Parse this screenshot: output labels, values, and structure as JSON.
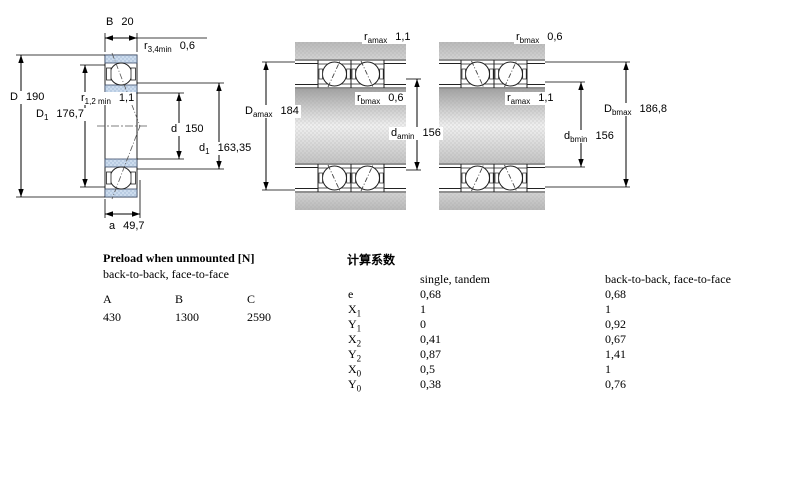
{
  "colors": {
    "bearing_ring_fill": "#ccdcee",
    "bearing_ring_dots": "#9db4d2",
    "line": "#000000",
    "housing_gray": "#c0c0c0",
    "shaft_gradient_light": "#f0f0f0",
    "background": "#ffffff"
  },
  "drawing_labels": {
    "single": {
      "B": {
        "base": "B",
        "sub": "",
        "value": "20"
      },
      "r34": {
        "base": "r",
        "sub": "3,4min",
        "value": "0,6"
      },
      "D": {
        "base": "D",
        "sub": "",
        "value": "190"
      },
      "D1": {
        "base": "D",
        "sub": "1",
        "value": "176,7"
      },
      "r12": {
        "base": "r",
        "sub": "1,2 min",
        "value": "1,1"
      },
      "d": {
        "base": "d",
        "sub": "",
        "value": "150"
      },
      "d1": {
        "base": "d",
        "sub": "1",
        "value": "163,35"
      },
      "a": {
        "base": "a",
        "sub": "",
        "value": "49,7"
      }
    },
    "pair_face_to_face": {
      "r_amax": {
        "base": "r",
        "sub": "amax",
        "value": "1,1"
      },
      "r_bmax": {
        "base": "r",
        "sub": "bmax",
        "value": "0,6"
      },
      "D_amax": {
        "base": "D",
        "sub": "amax",
        "value": "184"
      },
      "d_amin": {
        "base": "d",
        "sub": "amin",
        "value": "156"
      }
    },
    "pair_back_to_back": {
      "r_bmax": {
        "base": "r",
        "sub": "bmax",
        "value": "0,6"
      },
      "r_amax": {
        "base": "r",
        "sub": "amax",
        "value": "1,1"
      },
      "D_bmax": {
        "base": "D",
        "sub": "bmax",
        "value": "186,8"
      },
      "d_bmin": {
        "base": "d",
        "sub": "bmin",
        "value": "156"
      }
    }
  },
  "preload": {
    "title": "Preload when unmounted [N]",
    "subtitle": "back-to-back, face-to-face",
    "columns": [
      "A",
      "B",
      "C"
    ],
    "values": [
      "430",
      "1300",
      "2590"
    ]
  },
  "factors": {
    "title": "计算系数",
    "col1_header": "single, tandem",
    "col2_header": "back-to-back, face-to-face",
    "rows": [
      {
        "base": "e",
        "sub": "",
        "v1": "0,68",
        "v2": "0,68"
      },
      {
        "base": "X",
        "sub": "1",
        "v1": "1",
        "v2": "1"
      },
      {
        "base": "Y",
        "sub": "1",
        "v1": "0",
        "v2": "0,92"
      },
      {
        "base": "X",
        "sub": "2",
        "v1": "0,41",
        "v2": "0,67"
      },
      {
        "base": "Y",
        "sub": "2",
        "v1": "0,87",
        "v2": "1,41"
      },
      {
        "base": "X",
        "sub": "0",
        "v1": "0,5",
        "v2": "1"
      },
      {
        "base": "Y",
        "sub": "0",
        "v1": "0,38",
        "v2": "0,76"
      }
    ]
  }
}
